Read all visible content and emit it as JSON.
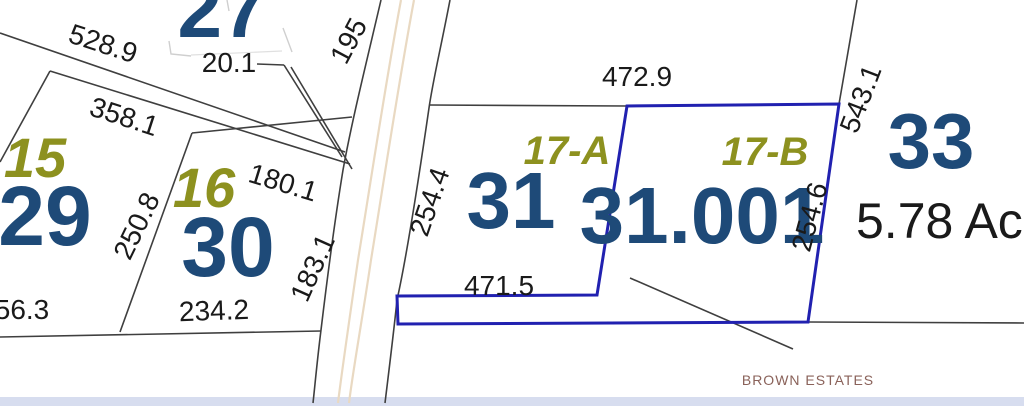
{
  "map": {
    "parcels": {
      "p27": {
        "number": "27"
      },
      "p15": {
        "number": "15"
      },
      "p29": {
        "number": "29"
      },
      "p16": {
        "number": "16"
      },
      "p30": {
        "number": "30"
      },
      "p31": {
        "number": "31",
        "lot": "17-A"
      },
      "p31_001": {
        "number": "31.001",
        "lot": "17-B"
      },
      "p33": {
        "number": "33",
        "area": "5.78 Ac"
      }
    },
    "dimensions": {
      "d528_9": "528.9",
      "d20_1": "20.1",
      "d195": "195",
      "d358_1": "358.1",
      "d180_1": "180.1",
      "d250_8": "250.8",
      "d183_1": "183.1",
      "d56_3": "56.3",
      "d234_2": "234.2",
      "d254_4": "254.4",
      "d472_9": "472.9",
      "d471_5": "471.5",
      "d254_6": "254.6",
      "d543_1": "543.1"
    },
    "annotations": {
      "subdivision": "BROWN ESTATES"
    }
  },
  "colors": {
    "parcel_number": "#1e4a78",
    "lot_label": "#8d911f",
    "dimension_text": "#1a1a1a",
    "boundary": "#3f3f3f",
    "selected_boundary": "#2121b0",
    "road_stripe": "#e9d9c2",
    "subdivision_text": "#8a625a",
    "water_band": "#d7ddef"
  }
}
